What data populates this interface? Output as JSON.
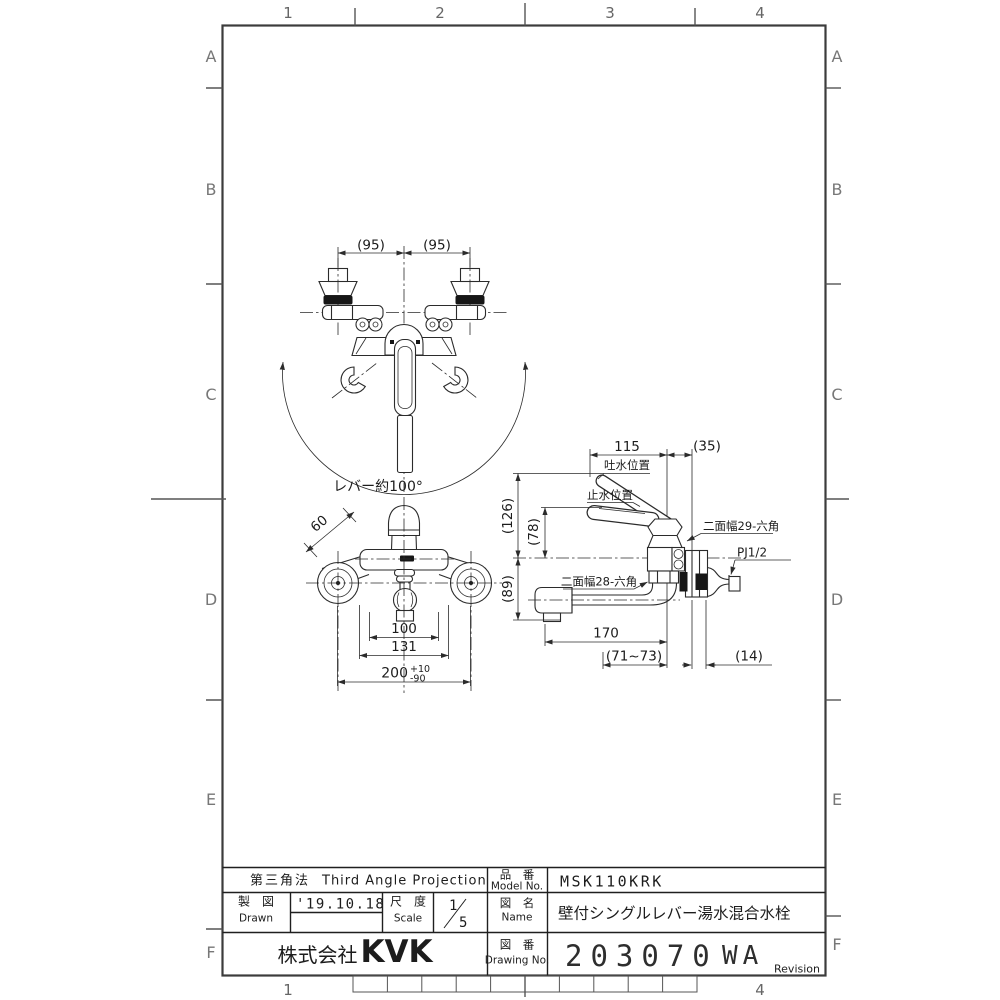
{
  "sheet": {
    "cols": [
      "1",
      "2",
      "3",
      "4"
    ],
    "rows": [
      "A",
      "B",
      "C",
      "D",
      "E",
      "F"
    ]
  },
  "title_block": {
    "projection_jp": "第三角法",
    "projection_en": "Third Angle Projection",
    "model_label_jp": "品　番",
    "model_label_en": "Model No.",
    "model_no": "MSK110KRK",
    "drawn_label_jp": "製　図",
    "drawn_label_en": "Drawn",
    "drawn_date": "'19.10.18",
    "scale_label_jp": "尺　度",
    "scale_label_en": "Scale",
    "scale_num": "1",
    "scale_den": "5",
    "name_label_jp": "図　名",
    "name_label_en": "Name",
    "product_name": "壁付シングルレバー湯水混合水栓",
    "company_prefix": "株式会社",
    "company_logo": "KVK",
    "drawing_no_label_jp": "図　番",
    "drawing_no_label_en": "Drawing No.",
    "drawing_no": "203070",
    "revision_code": "WA",
    "revision_label": "Revision"
  },
  "top_view": {
    "pitch_left": "(95)",
    "pitch_right": "(95)",
    "lever_angle": "レバー約100°"
  },
  "front_view": {
    "leg_od": "60",
    "width_inner": "100",
    "width_mid": "131",
    "pitch": "200",
    "tol_plus": "+10",
    "tol_minus": "-90"
  },
  "side_view": {
    "reach_top": "115",
    "offset_wall": "(35)",
    "label_discharge": "吐水位置",
    "label_stop": "止水位置",
    "label_hex29": "二面幅29-六角",
    "label_pj": "PJ1/2",
    "label_hex28": "二面幅28-六角",
    "height_lever": "(126)",
    "height_stop": "(78)",
    "drop_spout": "(89)",
    "spout_length": "170",
    "wall_clearance": "(71~73)",
    "flange_depth": "(14)"
  }
}
